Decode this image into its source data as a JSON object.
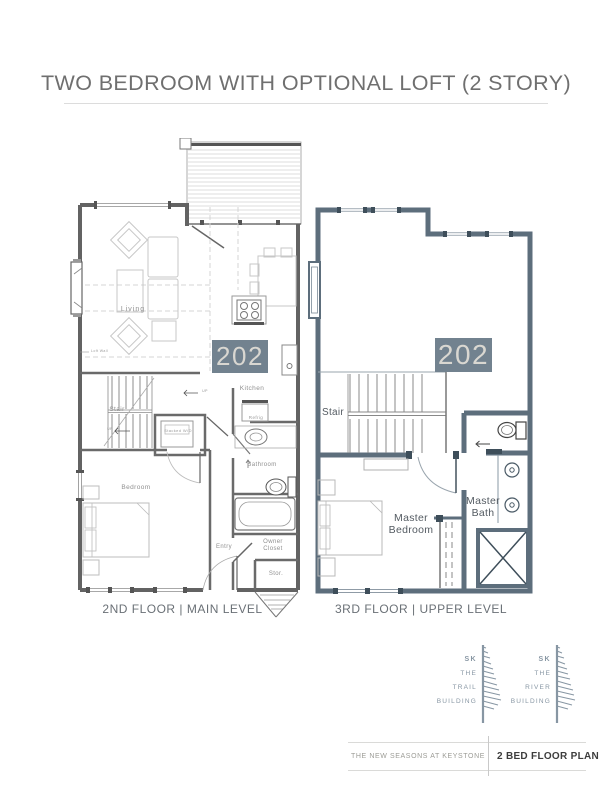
{
  "page": {
    "title": "TWO BEDROOM WITH OPTIONAL LOFT (2 STORY)"
  },
  "plans": {
    "left": {
      "caption": "2ND FLOOR | MAIN LEVEL",
      "unit_number": "202",
      "labels": {
        "living": "Living",
        "kitchen": "Kitchen",
        "refrig": "Refrig",
        "stair": "Stair",
        "stacked_wd": "Stacked W/D",
        "bathroom": "Bathroom",
        "bedroom": "Bedroom",
        "entry": "Entry",
        "owner_closet": "Owner Closet",
        "stor": "Stor.",
        "loft_wall": "Loft Wall",
        "up": "UP"
      }
    },
    "right": {
      "caption": "3RD FLOOR | UPPER LEVEL",
      "unit_number": "202",
      "labels": {
        "stair": "Stair",
        "master_bedroom": "Master Bedroom",
        "master_bath": "Master Bath"
      }
    }
  },
  "logos": [
    {
      "sk": "SK",
      "lines": [
        "THE",
        "TRAIL",
        "BUILDING"
      ]
    },
    {
      "sk": "SK",
      "lines": [
        "THE",
        "RIVER",
        "BUILDING"
      ]
    }
  ],
  "footer": {
    "left": "THE NEW SEASONS AT KEYSTONE",
    "right": "2 BED FLOOR PLAN"
  },
  "colors": {
    "badge_bg": "#72828f",
    "badge_text": "#d9d7d1",
    "wall_slate": "#5d6e7c",
    "wall_slate_dark": "#3e4e5a",
    "wall_gray": "#636363",
    "label_gray": "#909090",
    "label_dark": "#545b62",
    "title_gray": "#6f6f6f",
    "logo_slate": "#8796a3"
  }
}
